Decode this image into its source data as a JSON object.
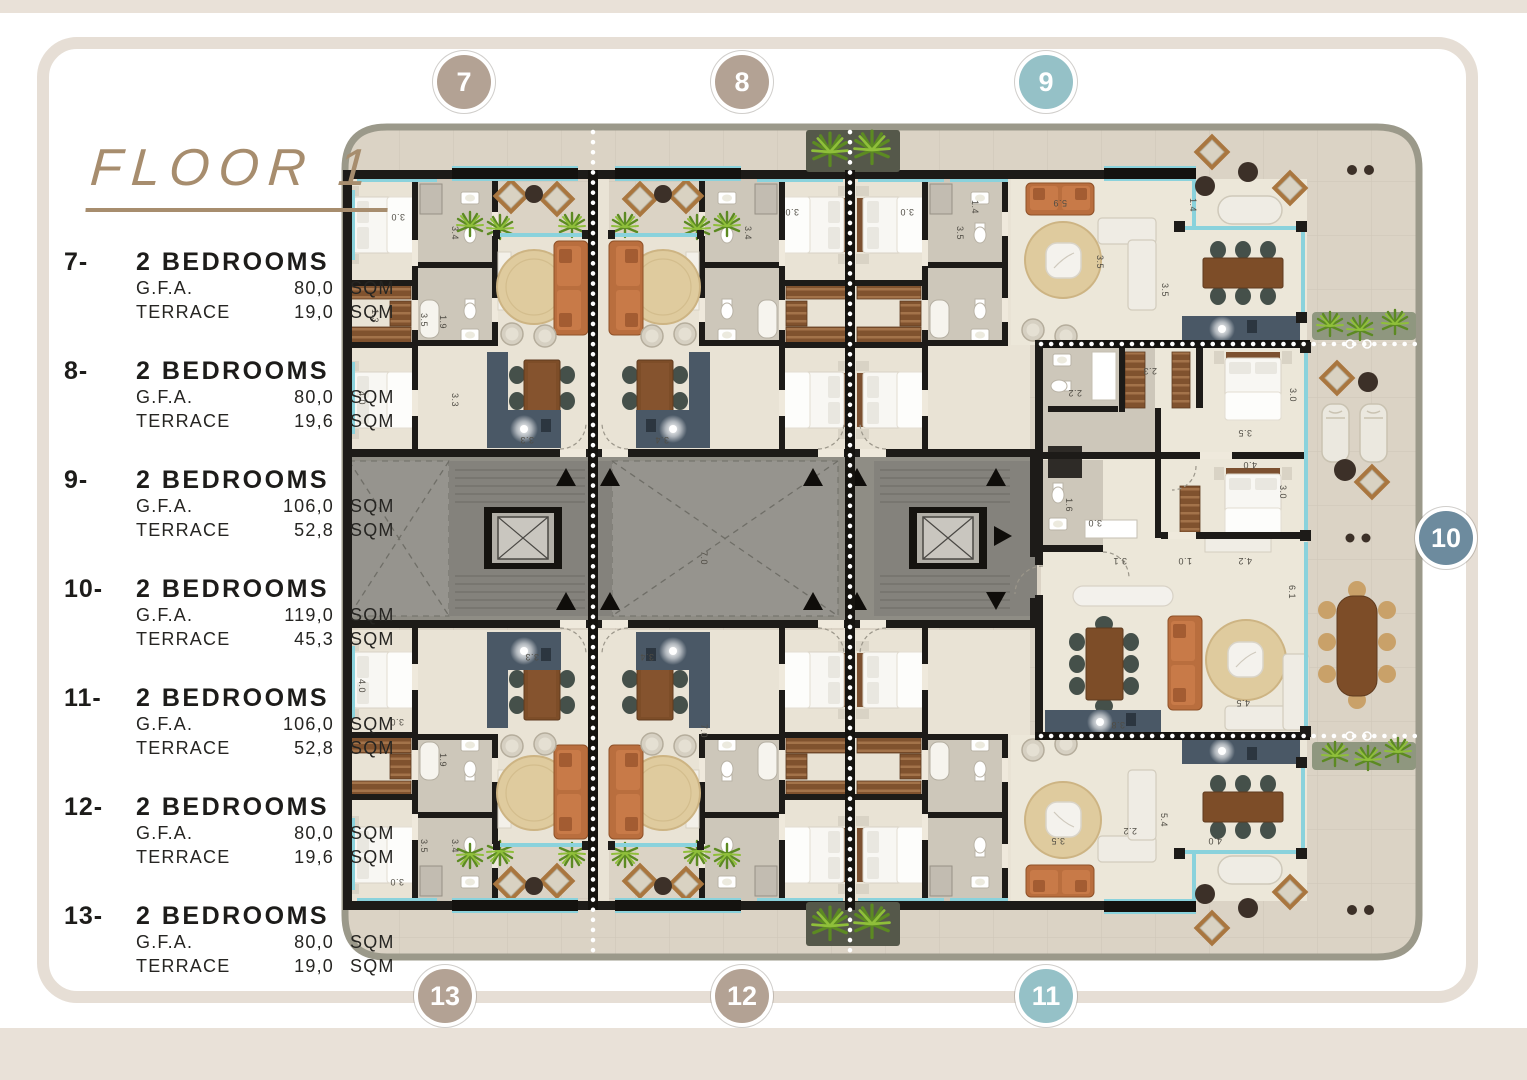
{
  "title": "FLOOR 1",
  "units": [
    {
      "id": "7-",
      "name": "2 BEDROOMS",
      "gfa_label": "G.F.A.",
      "gfa_value": "80,0",
      "gfa_unit": "SQM",
      "terrace_label": "TERRACE",
      "terrace_value": "19,0",
      "terrace_unit": "SQM"
    },
    {
      "id": "8-",
      "name": "2 BEDROOMS",
      "gfa_label": "G.F.A.",
      "gfa_value": "80,0",
      "gfa_unit": "SQM",
      "terrace_label": "TERRACE",
      "terrace_value": "19,6",
      "terrace_unit": "SQM"
    },
    {
      "id": "9-",
      "name": "2 BEDROOMS",
      "gfa_label": "G.F.A.",
      "gfa_value": "106,0",
      "gfa_unit": "SQM",
      "terrace_label": "TERRACE",
      "terrace_value": "52,8",
      "terrace_unit": "SQM"
    },
    {
      "id": "10-",
      "name": "2 BEDROOMS",
      "gfa_label": "G.F.A.",
      "gfa_value": "119,0",
      "gfa_unit": "SQM",
      "terrace_label": "TERRACE",
      "terrace_value": "45,3",
      "terrace_unit": "SQM"
    },
    {
      "id": "11-",
      "name": "2 BEDROOMS",
      "gfa_label": "G.F.A.",
      "gfa_value": "106,0",
      "gfa_unit": "SQM",
      "terrace_label": "TERRACE",
      "terrace_value": "52,8",
      "terrace_unit": "SQM"
    },
    {
      "id": "12-",
      "name": "2 BEDROOMS",
      "gfa_label": "G.F.A.",
      "gfa_value": "80,0",
      "gfa_unit": "SQM",
      "terrace_label": "TERRACE",
      "terrace_value": "19,6",
      "terrace_unit": "SQM"
    },
    {
      "id": "13-",
      "name": "2 BEDROOMS",
      "gfa_label": "G.F.A.",
      "gfa_value": "80,0",
      "gfa_unit": "SQM",
      "terrace_label": "TERRACE",
      "terrace_value": "19,0",
      "terrace_unit": "SQM"
    }
  ],
  "markers": [
    {
      "number": "7",
      "color": "#b3a294"
    },
    {
      "number": "8",
      "color": "#b3a294"
    },
    {
      "number": "9",
      "color": "#95c1c7"
    },
    {
      "number": "10",
      "color": "#6d8b9e"
    },
    {
      "number": "11",
      "color": "#95c1c7"
    },
    {
      "number": "12",
      "color": "#b3a294"
    },
    {
      "number": "13",
      "color": "#b3a294"
    }
  ],
  "colors": {
    "title": "#a78d6e",
    "marker_tan": "#b3a294",
    "marker_teal": "#95c1c7",
    "marker_blue": "#6d8b9e",
    "walls": "#1d1b18",
    "corridor": "#8f8d85",
    "window_glass": "#8ad2dc",
    "tile": "#dbd3c5",
    "floor": "#e9e3d5",
    "sofa": "#c0753f",
    "rug": "#dfcb9e",
    "kitchen": "#4a5866",
    "plant": "#6f9c2e"
  },
  "dimensions": [
    {
      "t": "3.0",
      "x": 398,
      "y": 214,
      "r": 180
    },
    {
      "t": "3.5",
      "x": 421,
      "y": 320,
      "r": 90
    },
    {
      "t": "3.4",
      "x": 452,
      "y": 233,
      "r": 90
    },
    {
      "t": "1.3",
      "x": 372,
      "y": 316,
      "r": 90
    },
    {
      "t": "1.9",
      "x": 440,
      "y": 322,
      "r": 90
    },
    {
      "t": "4.0",
      "x": 359,
      "y": 398,
      "r": 90
    },
    {
      "t": "3.3",
      "x": 452,
      "y": 400,
      "r": 90
    },
    {
      "t": "3.3",
      "x": 527,
      "y": 437,
      "r": 180
    },
    {
      "t": "7.0",
      "x": 701,
      "y": 558,
      "r": 90
    },
    {
      "t": "3.4",
      "x": 662,
      "y": 437,
      "r": 180
    },
    {
      "t": "3.0",
      "x": 792,
      "y": 209,
      "r": 180
    },
    {
      "t": "3.4",
      "x": 745,
      "y": 233,
      "r": 90
    },
    {
      "t": "3.0",
      "x": 907,
      "y": 209,
      "r": 180
    },
    {
      "t": "3.5",
      "x": 957,
      "y": 233,
      "r": 90
    },
    {
      "t": "1.4",
      "x": 972,
      "y": 207,
      "r": 90
    },
    {
      "t": "5.9",
      "x": 1060,
      "y": 200,
      "r": 180
    },
    {
      "t": "3.5",
      "x": 1097,
      "y": 262,
      "r": 90
    },
    {
      "t": "1.4",
      "x": 1190,
      "y": 205,
      "r": 90
    },
    {
      "t": "2.2",
      "x": 1075,
      "y": 390,
      "r": 180
    },
    {
      "t": "2.3",
      "x": 1150,
      "y": 368,
      "r": 180
    },
    {
      "t": "1.6",
      "x": 1066,
      "y": 505,
      "r": 90
    },
    {
      "t": "3.0",
      "x": 1095,
      "y": 520,
      "r": 180
    },
    {
      "t": "3.5",
      "x": 1245,
      "y": 430,
      "r": 180
    },
    {
      "t": "3.0",
      "x": 1290,
      "y": 395,
      "r": 90
    },
    {
      "t": "4.0",
      "x": 1250,
      "y": 462,
      "r": 180
    },
    {
      "t": "3.0",
      "x": 1280,
      "y": 492,
      "r": 90
    },
    {
      "t": "3.1",
      "x": 1120,
      "y": 558,
      "r": 180
    },
    {
      "t": "1.0",
      "x": 1185,
      "y": 558,
      "r": 180
    },
    {
      "t": "4.2",
      "x": 1245,
      "y": 558,
      "r": 180
    },
    {
      "t": "6.1",
      "x": 1289,
      "y": 592,
      "r": 90
    },
    {
      "t": "3.8",
      "x": 1118,
      "y": 722,
      "r": 180
    },
    {
      "t": "4.5",
      "x": 1243,
      "y": 700,
      "r": 180
    },
    {
      "t": "5.4",
      "x": 1161,
      "y": 820,
      "r": 90
    },
    {
      "t": "2.2",
      "x": 1130,
      "y": 828,
      "r": 180
    },
    {
      "t": "4.0",
      "x": 1215,
      "y": 838,
      "r": 180
    },
    {
      "t": "3.5",
      "x": 1058,
      "y": 838,
      "r": 180
    },
    {
      "t": "3.3",
      "x": 532,
      "y": 654,
      "r": 180
    },
    {
      "t": "3.4",
      "x": 647,
      "y": 654,
      "r": 180
    },
    {
      "t": "7.0",
      "x": 701,
      "y": 731,
      "r": 90
    },
    {
      "t": "4.0",
      "x": 359,
      "y": 686,
      "r": 90
    },
    {
      "t": "3.0",
      "x": 397,
      "y": 719,
      "r": 180
    },
    {
      "t": "1.9",
      "x": 440,
      "y": 760,
      "r": 90
    },
    {
      "t": "3.5",
      "x": 421,
      "y": 846,
      "r": 90
    },
    {
      "t": "3.4",
      "x": 452,
      "y": 846,
      "r": 90
    },
    {
      "t": "3.0",
      "x": 397,
      "y": 879,
      "r": 180
    },
    {
      "t": "3.5",
      "x": 1162,
      "y": 290,
      "r": 90
    }
  ]
}
